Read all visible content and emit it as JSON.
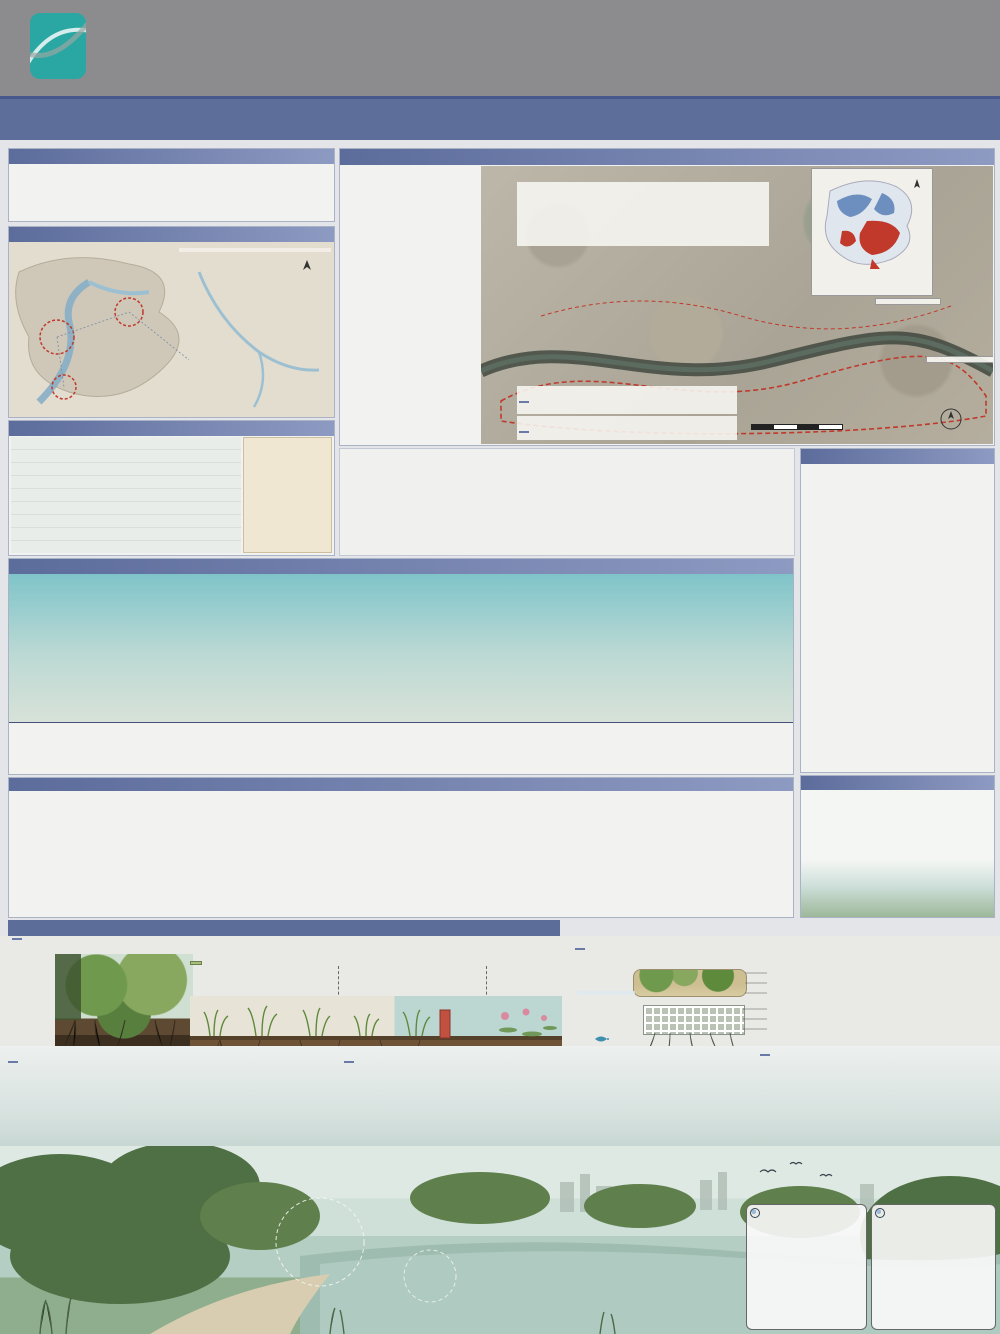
{
  "colors": {
    "brand_teal": "#2aa7a2",
    "header_gray": "#8c8c8e",
    "bar_blue": "#5e6e9b",
    "chip_blue": "#6a7aa8",
    "accent_red": "#c0392b",
    "navy": "#1e2a5e"
  },
  "header": {
    "logo_line1": "YUANYE",
    "logo_line2": "AWARDS",
    "logo_line3": "园 冶 杯",
    "reg_label": "报名序号:",
    "reg_code1": "LADKB",
    "reg_code2": "202500023217",
    "title_cn": "2025 园冶杯大学生国际竞赛",
    "title_en": "2025 YUANYE AWARDS International Competition for  Students"
  },
  "titlebar": {
    "main": "松廊织翠 · 水境焕新",
    "sub": "--衡阳松梅湖“活力+生态”主题综合公园设计",
    "page": "1/2"
  },
  "design_notes": {
    "title": "设计说明",
    "lines": [
      "该项目位于衡阳市石鼓区松梅湖片区，东靠小区等，西北紧邻湖南人机机械有限公司、润旭配件等，占地面积约30.16公顷。本项目以“活力+生态”为设计主题，依托场地现状与文脉，打造服务周边社区与产业工人群体的“活力与生态共生的综合公园”。",
      "设计核心在于“治理城市湿地并分区恢复”，将片区划分为上中下游三段，结合水流走向与周边业态：上游拦截工业区面源污染、中游承载社区活力与文化节点、下游专注生态净化与自然湿地构建，逐级实现水体的深度净化与生境修复。",
      "通过构建生态浮岛、梯级过滤带与低干扰建筑，恢复湿地生物多样性，串联文化节点与活力功能区，最终实现“人、湖、自然”的和谐共生。"
    ]
  },
  "location": {
    "title": "设计区位与文化梳理",
    "labels": [
      "三江汇流处",
      "湖南省",
      "衡阳市",
      "石鼓区",
      "松梅湖",
      "蒸水",
      "湘江",
      "耒水"
    ],
    "note": "项目位于蒸水与湘江交汇处上游，水流自西向东，场地周边以居住与工业用地为主，滨水文化资源丰富。",
    "north": "N"
  },
  "crowd": {
    "title": "区域人群分析",
    "columns": [
      "老年人",
      "中年人",
      "儿童"
    ],
    "note_black": "不同年龄段人群行为方式不一，具有自然活动特征差异，",
    "note_red": "需针对性布置活动场地与设施。"
  },
  "history": {
    "title": "生态治理历程",
    "axis": "生态综合指数",
    "years": [
      "1980",
      "2015",
      "2020",
      "2024"
    ],
    "curve": [
      22,
      26,
      22,
      35,
      43,
      60,
      70,
      71,
      63,
      65,
      56,
      50,
      41,
      36,
      32
    ],
    "eras": [
      {
        "title": "水质恶化时期",
        "lines": [
          "特点：重金属污染严重，水体黑臭。",
          "污染源：周边工业废水直排、生活污水汇入。",
          "现状：湖底淤积严重，鱼类绝迹，植被退化。",
          "治理：尚未开展系统治理。"
        ]
      },
      {
        "title": "初步治理时期",
        "lines": [
          "特点：截污纳管启动，水质仍为劣Ⅴ类。",
          "措施：关停排污口、清淤疏浚、垃圾清运。",
          "成效：黑臭现象缓解，局部水质改善。"
        ]
      },
      {
        "title": "生态修复时期",
        "lines": [
          "特点：水质提升至Ⅳ类，驳岸生态化改造。",
          "措施：构建人工湿地、种植净化植物。",
          "成效：生物多样性回升，景观初步形成。"
        ]
      },
      {
        "title": "活力焕新时期(规划)",
        "lines": [
          "特点：水质稳定达标，湿地系统完善。",
          "措施：植入活力功能、完善慢行系统。",
          "愿景：建成“活力+生态”主题综合公园。"
        ]
      }
    ]
  },
  "logic": {
    "title": "逻辑推导",
    "problems": [
      "问题一：水域水质污染严重",
      "问题二：使用功能分布零乱",
      "现状一：大量厂房荒置",
      "问题三：湿地系统不完整",
      "问题四：街道与景区联系不畅",
      "现状二：滨水垃圾堆放"
    ],
    "bubbles": [
      "工厂废水经管网混接直排入湖，水质长期为劣Ⅴ类",
      "驳岸硬质化严重，湿地斑块破碎化"
    ],
    "left_tags": [
      "水质净化",
      "生态修复",
      "功能重组",
      "文化植入",
      "活力激发"
    ],
    "flow_boxes": [
      "分级生态修复",
      "植物重新搭配",
      "进行水体精准净化",
      "自然湿地的构建",
      "重新规划多入口",
      "按需求设计功能区",
      "打造文化节点",
      "生态浮岛促效增益",
      "人群功能的适宜构建"
    ],
    "strategies": [
      {
        "tag": "策略一：分区分级与植物搭配",
        "text": "分区思路：将现状湖区划分为上中下游片区——上游近工业区以拦截净化为主，中游近居住区以“活力”功能为主，下游以“净化”与自然湿地为主。"
      },
      {
        "tag": "策略二：多元亲民的设计构建",
        "text": "聚焦多样人群需求，为各年龄段提供适宜的活动场地与滨水体验。"
      },
      {
        "tag": "策略三：传统技艺的增益输入",
        "text": "在通往上游亲水栈道的路径上布置文化展廊，将本地渔耕记忆融入景观节点之中。"
      },
      {
        "tag": "策略四：生态与经济可持续循环构建",
        "text": "通过生态浮岛与水中养殖（以渔养水、以上游净水汇入）叠加复合生态链，使湿地景观与运营收益形成良性循环。"
      }
    ]
  },
  "strategy_banner": "策略一：片段化分区的串联过程及其植物配置",
  "plan": {
    "title": "平面区位现状与初步规划",
    "submaps": [
      "交通分析出入口规划",
      "水流走向分析上中下游分区",
      "根据人群活动热力构建综合业态"
    ],
    "analysis": {
      "title": "平面区位现状分析：",
      "lines": [
        "基地现状为松梅湖沿线及周边不规则分布的用地。",
        "场地内建设用地与农林用地交错、杂乱无章，松梅湖片区是重点设计区域，周边为居住区与工业区包围的复合场地。",
        "同时考虑衡阳本地湿地气候特点，分析区域多样性与周边慢行空间的衔接情况，进而确定松梅湖规划的预留区范围，和现状进入人群热点的空间尺度与布局模式。"
      ]
    },
    "minimap": {
      "title": "衡阳市石鼓区用地现状图",
      "legend_title": "图例",
      "items": [
        {
          "label": "林地",
          "color": "#6d8fc0"
        },
        {
          "label": "耕地",
          "color": "#f5f2ea"
        },
        {
          "label": "水域",
          "color": "#a9c4e0"
        },
        {
          "label": "道路",
          "color": "#e8d4b8"
        },
        {
          "label": "人为活动区",
          "color": "#c0392b"
        }
      ]
    },
    "aerial_legend": {
      "title": "图例",
      "items": [
        {
          "label": "高密度居住区",
          "color": "#8a8a8a"
        },
        {
          "label": "商业服务区",
          "color": "#d8b48a"
        },
        {
          "label": "设计范围",
          "color": "#c0392b"
        },
        {
          "label": "规划绿地",
          "color": "#9fbe8f"
        },
        {
          "label": "水域",
          "color": "#9cc0d6"
        }
      ]
    },
    "climate": {
      "title": "气候分析",
      "items": [
        "气温",
        "降水",
        "风向",
        "日照"
      ]
    },
    "initial": {
      "title": "初步分析规划：",
      "text": "根据水流方向与污染梯度，初步划定上中下游净化分区，预留主要出入口与环湖慢行系统。"
    },
    "scalebar": "0   50  100        200m",
    "north": "N",
    "analysis_maps": [
      "海绵分析",
      "绿地斑块分析",
      "最宽间隙运输图",
      "250m服务覆盖范围",
      "水土流失前后",
      "2000-2024土地利用对比"
    ]
  },
  "evolution": {
    "title": "治理演变流程",
    "sections": [
      {
        "t": "土壤处理：",
        "x": "在之前的生态治理中，大部分土壤污染度已降至中度以下。首先分区采样，区分中度、轻度污染区域；轻度污染区撒石灰（1.5-3吨/亩）或硝酸钙石粉（pH升至6.5-7.5），螯合重金属离子；中度污染区覆盖30-50cm客土并混合改良土壤，使土壤生态逐步恢复。"
      },
      {
        "t": "景观引水：",
        "x": "修建涵养湿水的景观水池，将污水进行预过滤；设计水塘将雨水渗滤回收，通过水渠输送至需要灌溉的植物；多余雨水汇至下游蓄水池，降低养护成本。"
      },
      {
        "t": "生态系统的重建：",
        "x": "首先从驳岸修复到蓄水区，进行多样生态系统的重新规划，同时将生态栖息地分为水下区、浅滩区、水上流水区的构建。"
      },
      {
        "t": "植物种植：",
        "x": "从上游区、中游区到下游区进行分段式的植物搭配，促使水体与湿地景观的深层次净化，使废弃地区最终成为一个景观化的湿地系统。"
      },
      {
        "t": "低干扰建筑构造：",
        "x": "在湿地系统构建之后，进行低干扰园区及节点的构建，使公园在生态恢复的情况下，让人参与湿地公园景观的观赏之中。"
      }
    ],
    "soil_captions": [
      "轻度污染区域：撒石灰1.5-3吨/亩",
      "中度污染区域：覆盖30-50cm客土改良",
      "驳岸生态化分层构建"
    ],
    "table": {
      "title": "下游水区湿土搭配",
      "rows": [
        "下游区域：利用自然高差引导下游水成洼地(湿地)",
        "沉水层区：种植苦草吸附水底污染物净化水质",
        "挺水层区：芦苇+再力花（覆盖70%·混种30%）",
        "浮水层区：睡莲浮叶遮光抑制藻类繁殖",
        "底质改良：砂石+陶粒垫层过滤渗水"
      ]
    }
  },
  "bio": {
    "title": "治理生物多样规划",
    "zones": [
      "深水区",
      "浅滩区",
      "驳岸区"
    ]
  },
  "strategy1": {
    "intro1": "设计划将湖水分成上、中、下三个片区（上游靠近工业区、中游多靠近居住区、下游是废弃农田改造区），每个片区承担不同的净化任务。",
    "intro2": "上游作用：拦截面源污染、固土保水、降低水流冲刷；中游作用：深度降解污染物、增加水体透明度；下游作用：生态养殖与水质巩固提升。",
    "filter": {
      "chip": "生态过滤带",
      "cap1": "用芦苇和水葱组成第一层",
      "cap2": "将茭白和轮叶黑藻组成第二层",
      "note1": "拦截大颗粒污染物并吸收氮、磷营养盐",
      "note2": "减少水下光照抑制藻类，吸收易降解性污染物"
    },
    "island": {
      "chip": "生态浮岛与水中养殖",
      "note": "种植美人蕉、空心菜、黄菖蒲、旱伞草等植物构成生态浮岛",
      "o2": "O₂",
      "layers": [
        "25cm厚孔隙石笼",
        "10cm厚种植土",
        "20cm厚轻质陶粒基质",
        "防腐木框架",
        "椰棕纤维种植毯",
        "生物栖息网箱"
      ],
      "side": "浮岛结构采用可循环材料模块化拼装，便于更换与水下生物附着栖息。",
      "fish_note": "养殖滤食性鱼类净化水体"
    },
    "upstream": {
      "chip": "上游植物搭配与效果",
      "rows": [
        {
          "zone": "水上区：",
          "plants": [
            "池杉",
            "水杉",
            "枫杨",
            "芦竹"
          ]
        },
        {
          "zone": "浅水区：",
          "plants": [
            "黄菖蒲",
            "茭白",
            "再力花",
            "纸莎草"
          ]
        },
        {
          "zone": "水底区：",
          "plants": [
            "苦草",
            "狐尾藻",
            "黑藻"
          ]
        }
      ],
      "note": "在河流上游尾与中游衔接处建设缓冲过滤区，可实现：拦截上游大颗粒污染物及悬浮泥沙，让中游水体进行深度净化，完成污染物的吸收与沉降。"
    },
    "midstream": {
      "chip": "中游植物搭配与效果",
      "rows": [
        {
          "zone": "水上区：",
          "plants": [
            "木芙蓉",
            "木槿",
            "乌桕",
            "紫薇"
          ]
        },
        {
          "zone": "浅水区：",
          "plants": [
            "大花美人蕉",
            "水葱",
            "梭鱼草",
            "鸢尾"
          ]
        },
        {
          "zone": "水底区：",
          "plants": [
            "马来眼子菜",
            "金鱼藻"
          ]
        }
      ],
      "note": "植物净化与生态防护：降低悬浮物浓度、促进氮磷吸收、为鱼类提供栖息地；植物根系与微生物协同净化，逐步构建稳定的水生生态群落。"
    },
    "downstream": {
      "chip": "下游植物搭配与效果",
      "rows": [
        {
          "zone": "水上区：",
          "plants": [
            "玉兰",
            "桂花",
            "香樟",
            "银杏"
          ]
        },
        {
          "zone": "浅水区：",
          "plants": [
            "芦苇",
            "垂柳"
          ]
        },
        {
          "zone": "水底区：",
          "plants": [
            "睡莲",
            "荇菜"
          ]
        }
      ],
      "note": "生态浮岛（覆盖面积约12%），养殖滤食性鱼类（鲢、鳙），鱼类摄食浮游藻类，形成“以渔净水”的生态闭环，构成完整的水上—水下立体净化系统。"
    }
  },
  "stats": {
    "cards": [
      {
        "title": "总磷污染去除率",
        "value": "72.5%",
        "sub": "净化前 40.1 mg/L → 净化后 11.0 mg/L",
        "accent": "#8b3a3a"
      },
      {
        "title": "COD降解程度",
        "value": "81.2%",
        "sub": "净化前 102.3 mg/L → 净化后 18.7 mg/L",
        "accent": "#3f7d4e"
      },
      {
        "title": "溶解氧含量提升",
        "value": "+155%",
        "sub": "净化前 3.0 mg/L → 净化后 7.7 mg/L",
        "accent": "#3e6d8e"
      },
      {
        "title": "水体透明度提升",
        "value": "+210%",
        "sub": "净化前 18.2 cm → 净化后 56.4 cm",
        "accent": "#6b705c"
      }
    ]
  },
  "chart_data": [
    {
      "type": "line",
      "title": "主要水质参数变化趋势",
      "x": [
        "进水口",
        "上游区",
        "中游区",
        "下游区"
      ],
      "series": [
        {
          "name": "COD污染指数",
          "color": "#8b2d3f",
          "values": [
            85,
            62,
            38,
            15
          ]
        },
        {
          "name": "氨氮指数",
          "color": "#7b3fa0",
          "values": [
            18,
            12,
            8,
            6
          ]
        },
        {
          "name": "总磷指数",
          "color": "#2e8b57",
          "values": [
            10,
            8,
            6,
            5
          ]
        },
        {
          "name": "溶解氧含量",
          "color": "#3a6fc4",
          "values": [
            22,
            28,
            42,
            58
          ]
        }
      ],
      "ylim": [
        0,
        90
      ],
      "ylabel": "浓度(mg/L)",
      "legend_position": "top",
      "grid": true
    },
    {
      "type": "hbar",
      "title": "不同区域净化效果对比",
      "categories": [
        "芦苇区",
        "人工湿地",
        "浮岛区域",
        "水下森林",
        "出水口区"
      ],
      "series": [
        {
          "name": "净化前浓度",
          "color": "#9aa0a6",
          "values": [
            95,
            88,
            92,
            78,
            90
          ]
        },
        {
          "name": "净化后浓度",
          "color": "#4bacc6",
          "values": [
            20,
            32,
            24,
            18,
            28
          ]
        }
      ],
      "xlim": [
        0,
        100
      ],
      "xlabel": "浓度值(mg/L)",
      "grid": true
    }
  ]
}
